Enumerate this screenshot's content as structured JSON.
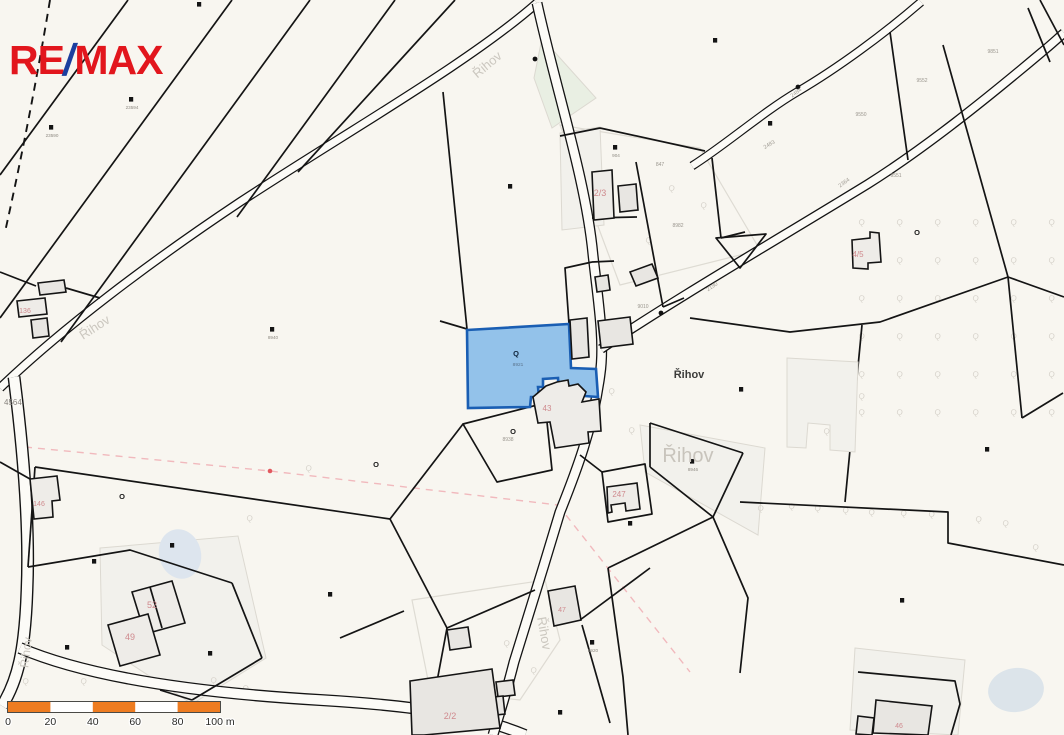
{
  "logo": {
    "re": "RE",
    "slash": "/",
    "max": "MAX",
    "red": "#e2161d",
    "blue": "#1c3f9f"
  },
  "map": {
    "background": "#f8f6f0",
    "boundary_color": "#141414",
    "road_fill": "#fcfbf7",
    "building_fill": "#e8e6e2",
    "pond_color": "#dde5ee",
    "highlight_parcel": {
      "fill": "#93c2ea",
      "stroke": "#1a5eb3",
      "number": "8921",
      "symbol": "Q"
    },
    "place_labels": [
      {
        "t": "Řihov",
        "x": 689,
        "y": 378,
        "s": 11,
        "c": "#3c3c3a",
        "b": 1,
        "r": 0
      },
      {
        "t": "Řihov",
        "x": 688,
        "y": 462,
        "s": 20,
        "c": "#c8c4bc",
        "r": 0
      },
      {
        "t": "Řihov",
        "x": 490,
        "y": 68,
        "s": 13,
        "c": "#cbc7bf",
        "r": -40
      },
      {
        "t": "Řihov",
        "x": 97,
        "y": 331,
        "s": 13,
        "c": "#cbc7bf",
        "r": -33
      },
      {
        "t": "Řihov",
        "x": 540,
        "y": 634,
        "s": 13,
        "c": "#cbc7bf",
        "r": 80
      },
      {
        "t": "Řihov",
        "x": 30,
        "y": 653,
        "s": 12,
        "c": "#cbc7bf",
        "r": -83
      }
    ],
    "road_labels": [
      {
        "t": "2190",
        "x": 713,
        "y": 288,
        "r": -33
      },
      {
        "t": "2364",
        "x": 845,
        "y": 184,
        "r": -36
      },
      {
        "t": "2484",
        "x": 797,
        "y": 94,
        "r": -36
      },
      {
        "t": "2483",
        "x": 770,
        "y": 146,
        "r": -30
      }
    ],
    "parcel_numbers": [
      {
        "t": "8982",
        "x": 678,
        "y": 227
      },
      {
        "t": "9550",
        "x": 861,
        "y": 116
      },
      {
        "t": "9552",
        "x": 922,
        "y": 82
      },
      {
        "t": "9851",
        "x": 993,
        "y": 53
      },
      {
        "t": "9551",
        "x": 896,
        "y": 177
      },
      {
        "t": "8938",
        "x": 508,
        "y": 441
      },
      {
        "t": "9010",
        "x": 643,
        "y": 308
      },
      {
        "t": "847",
        "x": 660,
        "y": 166
      },
      {
        "t": "4564",
        "x": 4,
        "y": 405,
        "s": 8,
        "c": "#87837d"
      }
    ],
    "house_numbers": [
      {
        "t": "2/3",
        "x": 600,
        "y": 196,
        "s": 9
      },
      {
        "t": "43",
        "x": 547,
        "y": 411,
        "s": 8
      },
      {
        "t": "247",
        "x": 619,
        "y": 497,
        "s": 8
      },
      {
        "t": "2/2",
        "x": 450,
        "y": 719,
        "s": 9
      },
      {
        "t": "52",
        "x": 152,
        "y": 608,
        "s": 9
      },
      {
        "t": "49",
        "x": 130,
        "y": 640,
        "s": 9
      },
      {
        "t": "4/5",
        "x": 858,
        "y": 257,
        "s": 8
      },
      {
        "t": "136",
        "x": 25,
        "y": 313,
        "s": 7
      },
      {
        "t": "146",
        "x": 39,
        "y": 506,
        "s": 7
      },
      {
        "t": "47",
        "x": 562,
        "y": 612,
        "s": 7
      },
      {
        "t": "46",
        "x": 899,
        "y": 728,
        "s": 7
      }
    ],
    "square_symbols": [
      {
        "x": 199,
        "y": 4,
        "l": ""
      },
      {
        "x": 131,
        "y": 99,
        "l": "23594"
      },
      {
        "x": 51,
        "y": 127,
        "l": "23590"
      },
      {
        "x": 272,
        "y": 329,
        "l": "8940"
      },
      {
        "x": 510,
        "y": 186,
        "l": ""
      },
      {
        "x": 615,
        "y": 147,
        "l": "904"
      },
      {
        "x": 715,
        "y": 40,
        "l": ""
      },
      {
        "x": 770,
        "y": 123,
        "l": ""
      },
      {
        "x": 741,
        "y": 389,
        "l": ""
      },
      {
        "x": 692,
        "y": 461,
        "l": "8946"
      },
      {
        "x": 902,
        "y": 600,
        "l": ""
      },
      {
        "x": 987,
        "y": 449,
        "l": ""
      },
      {
        "x": 172,
        "y": 545,
        "l": ""
      },
      {
        "x": 94,
        "y": 561,
        "l": ""
      },
      {
        "x": 67,
        "y": 647,
        "l": ""
      },
      {
        "x": 210,
        "y": 653,
        "l": ""
      },
      {
        "x": 330,
        "y": 594,
        "l": ""
      },
      {
        "x": 630,
        "y": 523,
        "l": ""
      },
      {
        "x": 592,
        "y": 642,
        "l": "8920"
      },
      {
        "x": 560,
        "y": 712,
        "l": ""
      }
    ],
    "o_symbols": [
      {
        "x": 513,
        "y": 431
      },
      {
        "x": 917,
        "y": 232
      },
      {
        "x": 376,
        "y": 464
      },
      {
        "x": 122,
        "y": 496
      }
    ],
    "dot_symbols": [
      {
        "x": 661,
        "y": 313
      },
      {
        "x": 535,
        "y": 59
      },
      {
        "x": 798,
        "y": 87
      }
    ],
    "orchard_grid": {
      "x0": 858,
      "y0": 224,
      "dx": 38,
      "dy": 38,
      "cols": 6,
      "rows": 6
    },
    "orchard_extra": [
      {
        "x": 505,
        "y": 363
      },
      {
        "x": 542,
        "y": 362
      },
      {
        "x": 470,
        "y": 362
      },
      {
        "x": 476,
        "y": 398
      },
      {
        "x": 246,
        "y": 520
      },
      {
        "x": 210,
        "y": 682
      },
      {
        "x": 242,
        "y": 690
      },
      {
        "x": 80,
        "y": 683
      },
      {
        "x": 22,
        "y": 683
      },
      {
        "x": 503,
        "y": 645
      },
      {
        "x": 530,
        "y": 672
      },
      {
        "x": 823,
        "y": 400
      },
      {
        "x": 858,
        "y": 398
      },
      {
        "x": 823,
        "y": 433
      },
      {
        "x": 757,
        "y": 510
      },
      {
        "x": 788,
        "y": 508
      },
      {
        "x": 814,
        "y": 510
      },
      {
        "x": 842,
        "y": 512
      },
      {
        "x": 868,
        "y": 514
      },
      {
        "x": 900,
        "y": 515
      },
      {
        "x": 928,
        "y": 516
      },
      {
        "x": 975,
        "y": 521
      },
      {
        "x": 1002,
        "y": 525
      },
      {
        "x": 1032,
        "y": 549
      },
      {
        "x": 645,
        "y": 242
      },
      {
        "x": 700,
        "y": 207
      },
      {
        "x": 668,
        "y": 190
      },
      {
        "x": 608,
        "y": 393
      },
      {
        "x": 628,
        "y": 432
      },
      {
        "x": 305,
        "y": 470
      }
    ],
    "scalebar": {
      "x": 8,
      "y": 702,
      "w": 212,
      "h": 10,
      "orange": "#ee7c21",
      "white": "#ffffff",
      "border": "#4a4a46",
      "segments": [
        "orange",
        "white",
        "orange",
        "white",
        "orange"
      ],
      "ticks": [
        "0",
        "20",
        "40",
        "60",
        "80",
        "100 m"
      ]
    }
  }
}
